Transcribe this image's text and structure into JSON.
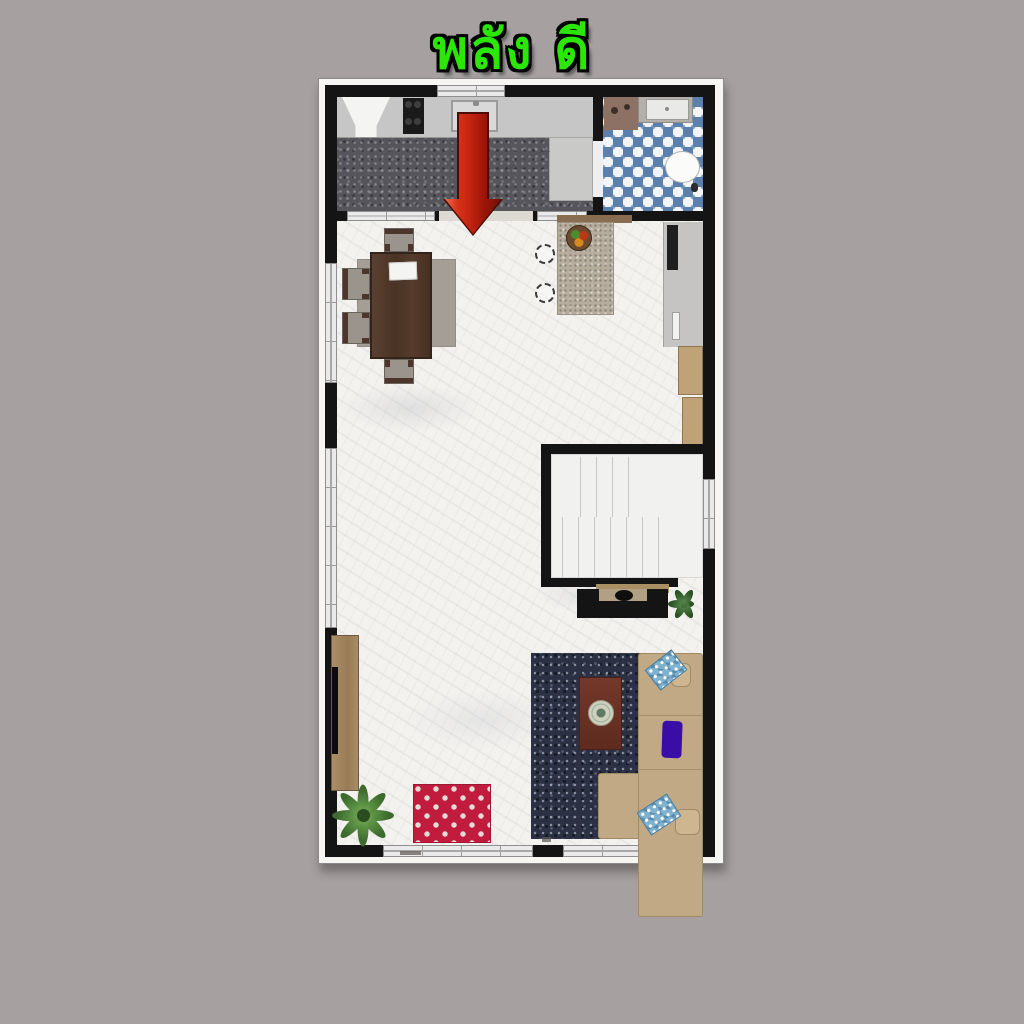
{
  "title": {
    "text": "พลัง ดี",
    "color": "#2be607",
    "outline_color": "#000000"
  },
  "canvas": {
    "background_color": "#a6a0a1",
    "width": 1024,
    "height": 1024
  },
  "floor_plan": {
    "kind": "apartment-floor-plan-top-view",
    "border_color": "#f7f6f3",
    "wall_color": "#141414",
    "entrance_arrow": {
      "direction": "down",
      "color": "#c22410",
      "outline": "#4d0b02"
    },
    "rooms": [
      {
        "name": "kitchen",
        "floor_color": "#55555b",
        "features": [
          "range-hood",
          "cooktop-4-burners",
          "sink",
          "counter",
          "door-swing"
        ]
      },
      {
        "name": "bathroom",
        "tile_colors": [
          "#5c80ad",
          "#f2f4f6"
        ],
        "features": [
          "shower-mat",
          "vanity-sink",
          "toilet"
        ]
      },
      {
        "name": "living-dining-room",
        "floor_color": "#f3f2ef",
        "features": [
          "dining-table",
          "dining-chairs-4",
          "gray-area-rug",
          "island-counter",
          "fruit-bowl",
          "bar-stools-2",
          "tall-appliance-counter",
          "tan-cabinets",
          "staircase",
          "tv-console",
          "plants-2",
          "navy-area-rug",
          "coffee-table",
          "l-shaped-sofa",
          "pillows-3",
          "red-polka-rug",
          "wall-tv-cabinet"
        ]
      }
    ],
    "furniture_colors": {
      "dining_table": "#4f382b",
      "chair_seat": "#9a948d",
      "island_granite": "#b6ad9e",
      "sofa": "#c2a985",
      "navy_rug": "#2b3143",
      "red_rug": "#c11b3e",
      "coffee_table": "#6a3326",
      "tan_cabinet": "#bfa278",
      "purple_pillow": "#3a0da6",
      "blue_pillow": "#7fb2cf",
      "plant_green": "#3c6b2d",
      "stairs": "#f1f1f0"
    }
  }
}
